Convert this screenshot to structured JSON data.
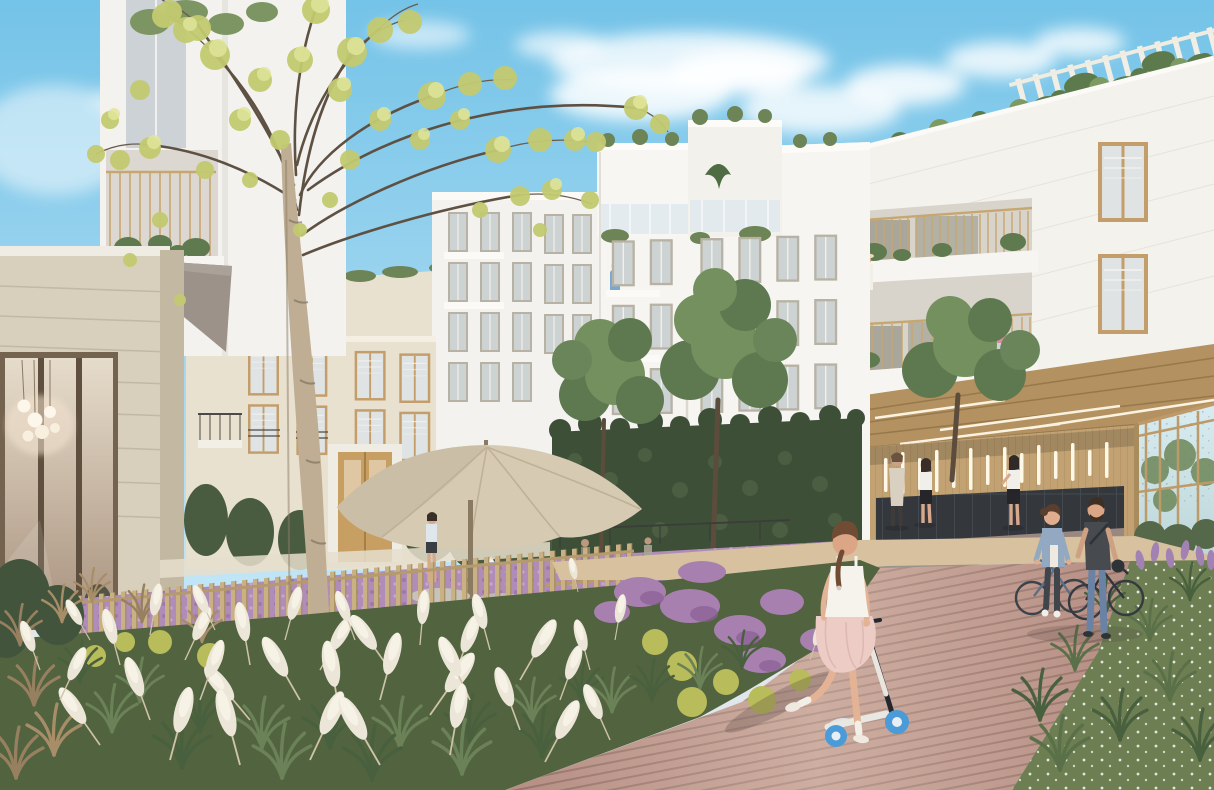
{
  "scene": {
    "description": "Architectural rendering of a new residential courtyard: white apartment buildings with gold balcony railings surround a planted garden of pampas grass and purple meadow flowers; a little girl rides a scooter on a wooden boardwalk toward a couple walking bicycles near a covered passage with wood slats, light strips, mailboxes and a glass lobby; a large spring tree and a beige parasol stand on the left.",
    "sky": {
      "label": "blue sky with soft white clouds"
    },
    "buildings": {
      "left_foreground": "beige stone building with lobby window and pendant lights",
      "left_tower": "white corner building with gold-railed balcony and taupe awning",
      "background_left": "cream apartment building with tan windows and entrance door",
      "center": "stepped white apartment building with glass-railed roof terraces",
      "right": "white stone building with recessed gold balconies and rooftop pergola",
      "passage": "covered passage: wood slat wall, vertical light strips, dark mailboxes, glass lobby"
    },
    "landscape": {
      "garden": "pampas grass bed with white plumes, green tufts and dried grasses",
      "meadow": "purple flowering meadow behind a light wood picket fence",
      "boardwalk": "dusty-rose wooden plank path",
      "lawn": "green bed with tiny white flowers",
      "parasol": "large beige garden umbrella",
      "tree": "tall young tree with sparse yellow-green spring foliage",
      "green_wall": "ivy-covered ground-floor wall"
    },
    "figures": {
      "girl": "girl in white top and pink tulle skirt riding a blue-wheeled scooter",
      "couple": "woman in denim jacket and man in dark t-shirt walking bicycles",
      "passage_people": "three residents near the mailboxes",
      "umbrella_person": "person standing under the parasol",
      "balcony_residents": "woman with straw hat and woman with orange bag on balconies"
    }
  },
  "palette": {
    "sky_top": "#74c3e8",
    "sky_horizon": "#c2e6f6",
    "cloud": "#ffffff",
    "right_facade": "#f4f2ed",
    "center_facade": "#f3f2ee",
    "cream_facade": "#e9e1cf",
    "beige_facade": "#d8d0bd",
    "beige_dark": "#c3b8a2",
    "awning": "#9c9289",
    "window_frame": "#c49e6a",
    "glass": "#dfe3e4",
    "railing_gold": "#c6a76f",
    "terrace_glass": "#dfe9ee",
    "passage_wood": "#c2a273",
    "ceiling_wood": "#b39160",
    "light_strip": "#fff8e6",
    "mailbox": "#34383d",
    "stone_base": "#9a8780",
    "lobby_glass": "#cfe3e8",
    "floor_gray": "#98938b",
    "green_wall": "#3e4f38",
    "canopy": "#5e7950",
    "canopy_light": "#74905f",
    "shrub_dark": "#4c5f42",
    "spring_foliage": "#c3ca70",
    "spring_foliage_light": "#e0e59a",
    "trunk_birch": "#bfae94",
    "branch": "#5e5143",
    "parasol": "#d6cab3",
    "fence": "#c9b184",
    "rail_wood": "#b59a6d",
    "meadow": "#b08cb8",
    "heather": "#a780b0",
    "plume": "#ece6d8",
    "plume_light": "#f6f2e6",
    "bed_green": "#51633f",
    "tuft_dark": "#49603e",
    "tuft_light": "#6b8157",
    "dried": "#97805f",
    "yellow": "#b9bc5a",
    "boardwalk": "#b68e83",
    "plank": "#7c5d55",
    "curb": "#c79f8c",
    "dirt": "#d7c19f",
    "lawn": "#6d7f52",
    "flower_white": "#ffffff",
    "skin": "#e0ad8e",
    "hair": "#6f4c33",
    "girl_top": "#f6f3ec",
    "skirt": "#edccc6",
    "scooter": "#4a9bd8",
    "denim": "#93a9c2",
    "jeans": "#6a82a4",
    "tshirt": "#474b50",
    "coat_beige": "#d9d0c1"
  }
}
